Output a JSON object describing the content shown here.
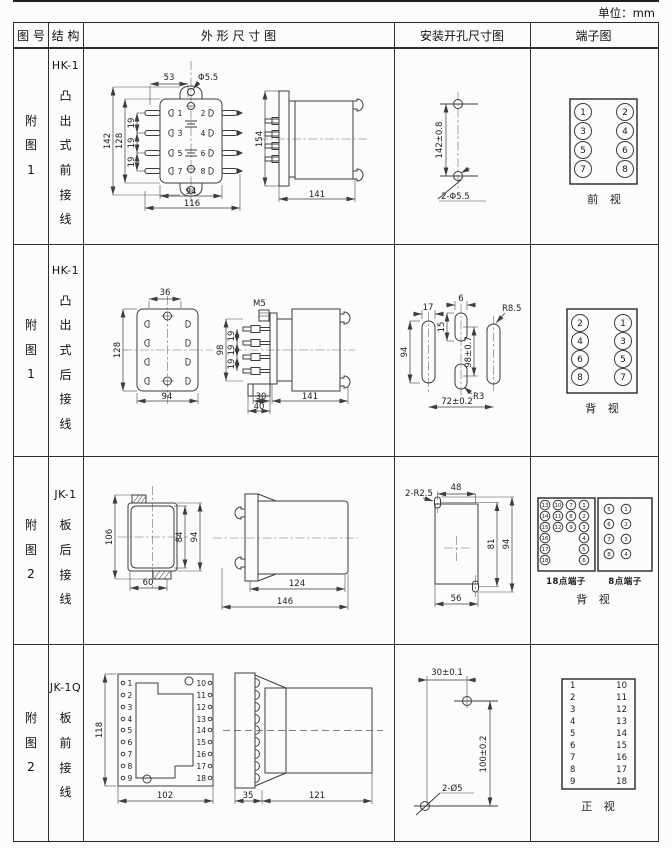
{
  "unit": "单位：mm",
  "header": {
    "c1": "图 号",
    "c2": "结 构",
    "c3": "外 形 尺 寸 图",
    "c4": "安装开孔尺寸图",
    "c5": "端子图"
  },
  "r1": {
    "fig": "附图1",
    "model": "HK-1",
    "desc": "凸出式前接线",
    "front": {
      "d53": "53",
      "dphi": "Φ5.5",
      "d142": "142",
      "d128": "128",
      "d19": "19",
      "d94": "94",
      "d116": "116"
    },
    "side": {
      "d154": "154",
      "d141": "141"
    },
    "mount": {
      "dv": "142±0.8",
      "holes": "2-Φ5.5"
    },
    "term": {
      "n": [
        [
          "1",
          "2"
        ],
        [
          "3",
          "4"
        ],
        [
          "5",
          "6"
        ],
        [
          "7",
          "8"
        ]
      ],
      "cap": "前 视"
    }
  },
  "r2": {
    "fig": "附图1",
    "model": "HK-1",
    "desc": "凸出式后接线",
    "rear": {
      "d36": "36",
      "d128": "128",
      "d94": "94"
    },
    "side": {
      "m5": "M5",
      "d98": "98",
      "d19": "19",
      "d30": "30",
      "d40": "40",
      "d141": "141"
    },
    "mount": {
      "d17": "17",
      "d6": "6",
      "r85": "R8.5",
      "d15": "15",
      "d94": "94",
      "d98": "98±0.7",
      "r3": "R3",
      "d72": "72±0.2"
    },
    "term": {
      "n": [
        [
          "2",
          "1"
        ],
        [
          "4",
          "3"
        ],
        [
          "6",
          "5"
        ],
        [
          "8",
          "7"
        ]
      ],
      "cap": "背 视"
    }
  },
  "r3": {
    "fig": "附图2",
    "model": "JK-1",
    "desc": "板后接线",
    "rear": {
      "d106": "106",
      "d84": "84",
      "d94": "94",
      "d60": "60"
    },
    "side": {
      "d124": "124",
      "d146": "146"
    },
    "mount": {
      "r25": "2-R2.5",
      "d48": "48",
      "d81": "81",
      "d94": "94",
      "d56": "56"
    },
    "term18": {
      "label": "18点端子",
      "g": [
        [
          "13",
          "10",
          "7",
          "1"
        ],
        [
          "14",
          "11",
          "8",
          "2"
        ],
        [
          "15",
          "12",
          "9",
          "3"
        ],
        [
          "16",
          "",
          "",
          "4"
        ],
        [
          "17",
          "",
          "",
          "5"
        ],
        [
          "18",
          "",
          "",
          "6"
        ]
      ]
    },
    "term8": {
      "label": "8点端子",
      "g": [
        [
          "5",
          "1"
        ],
        [
          "6",
          "2"
        ],
        [
          "7",
          "3"
        ],
        [
          "8",
          "4"
        ]
      ]
    },
    "cap": "背 视"
  },
  "r4": {
    "fig": "附图2",
    "model": "JK-1Q",
    "desc": "板前接线",
    "front": {
      "d118": "118",
      "d102": "102"
    },
    "side": {
      "d35": "35",
      "d121": "121"
    },
    "mount": {
      "d30": "30±0.1",
      "d100": "100±0.2",
      "holes": "2-Ø5"
    },
    "term": {
      "left": [
        "1",
        "2",
        "3",
        "4",
        "5",
        "6",
        "7",
        "8",
        "9"
      ],
      "right": [
        "10",
        "11",
        "12",
        "13",
        "14",
        "15",
        "16",
        "17",
        "18"
      ],
      "cap": "正 视"
    }
  }
}
